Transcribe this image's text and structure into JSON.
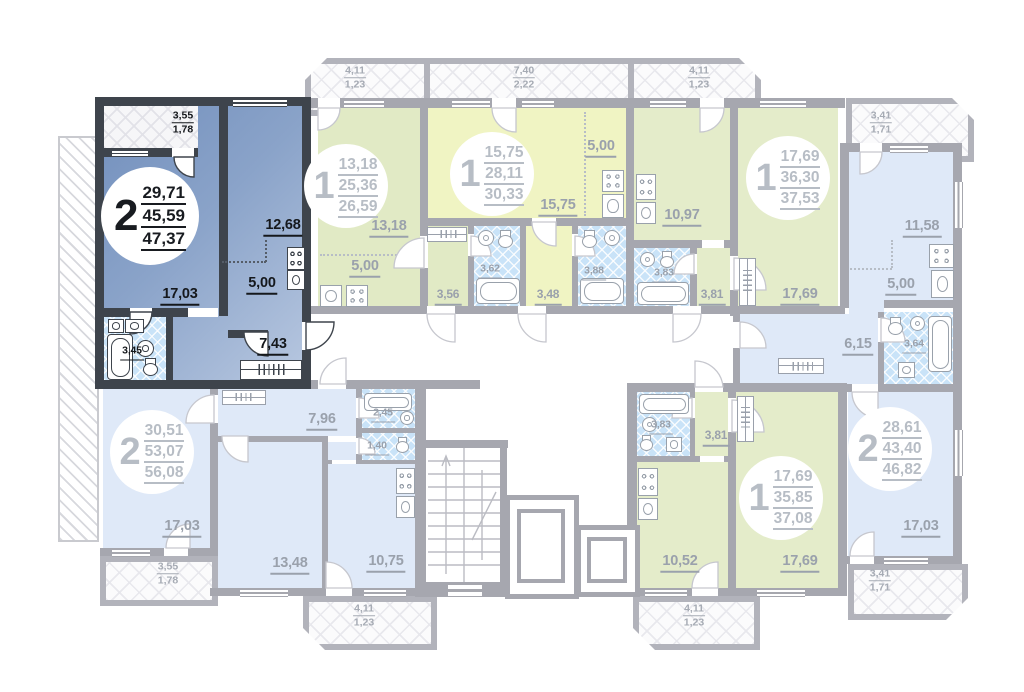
{
  "colors": {
    "highlight_wall": "#3e444c",
    "highlight_fill": "#7390bd",
    "wall": "#a6a7af",
    "green_fill": "#e1eac5",
    "yellow_fill": "#f0f4c3",
    "blue_fill": "#dfe9f8",
    "bath_tile": "#c9e3f8",
    "label_grey": "#9aa1ac"
  },
  "apartments": [
    {
      "name": "apartment-2room-selected",
      "rooms": "2",
      "living": "29,71",
      "area": "45,59",
      "total": "47,37",
      "labels": {
        "room": "17,03",
        "kitchen_living": "12,68",
        "kitchen": "5,00",
        "hall": "7,43",
        "bath": "3,45"
      },
      "balcony": {
        "a": "3,55",
        "k": "1,78"
      }
    },
    {
      "name": "apartment-1room-a",
      "rooms": "1",
      "living": "13,18",
      "area": "25,36",
      "total": "26,59",
      "labels": {
        "room": "13,18",
        "kitchen": "5,00",
        "hall": "3,56",
        "bath": "3,62"
      },
      "balcony": {
        "a": "4,11",
        "k": "1,23"
      }
    },
    {
      "name": "apartment-1room-b",
      "rooms": "1",
      "living": "15,75",
      "area": "28,11",
      "total": "30,33",
      "labels": {
        "room": "15,75",
        "kitchen": "5,00",
        "hall": "3,48",
        "bath": "3,88"
      },
      "balcony": {
        "a": "7,40",
        "k": "2,22"
      }
    },
    {
      "name": "apartment-1room-c",
      "rooms": "1",
      "living": "17,69",
      "area": "36,30",
      "total": "37,53",
      "labels": {
        "room": "17,69",
        "kitchen": "10,97",
        "hall": "3,81",
        "bath": "3,83"
      },
      "balcony": {
        "a": "4,11",
        "k": "1,23"
      }
    },
    {
      "name": "apartment-2room-right",
      "rooms": "2",
      "living": "28,61",
      "area": "43,40",
      "total": "46,82",
      "labels": {
        "room": "17,03",
        "kitchen_living": "11,58",
        "kitchen": "5,00",
        "hall": "6,15",
        "bath": "3,64"
      },
      "balcony": {
        "a": "3,41",
        "k": "1,71"
      },
      "balcony2": {
        "a": "3,41",
        "k": "1,71"
      }
    },
    {
      "name": "apartment-2room-bottom",
      "rooms": "2",
      "living": "30,51",
      "area": "53,07",
      "total": "56,08",
      "labels": {
        "room1": "17,03",
        "room2": "13,48",
        "kitchen": "10,75",
        "hall": "7,96",
        "bath": "2,45",
        "wc": "1,40"
      },
      "balcony": {
        "a": "3,55",
        "k": "1,78"
      },
      "balcony2": {
        "a": "4,11",
        "k": "1,23"
      }
    },
    {
      "name": "apartment-1room-d",
      "rooms": "1",
      "living": "17,69",
      "area": "35,85",
      "total": "37,08",
      "labels": {
        "room": "17,69",
        "kitchen": "10,52",
        "hall": "3,81",
        "bath": "3,83"
      },
      "balcony": {
        "a": "4,11",
        "k": "1,23"
      }
    }
  ]
}
